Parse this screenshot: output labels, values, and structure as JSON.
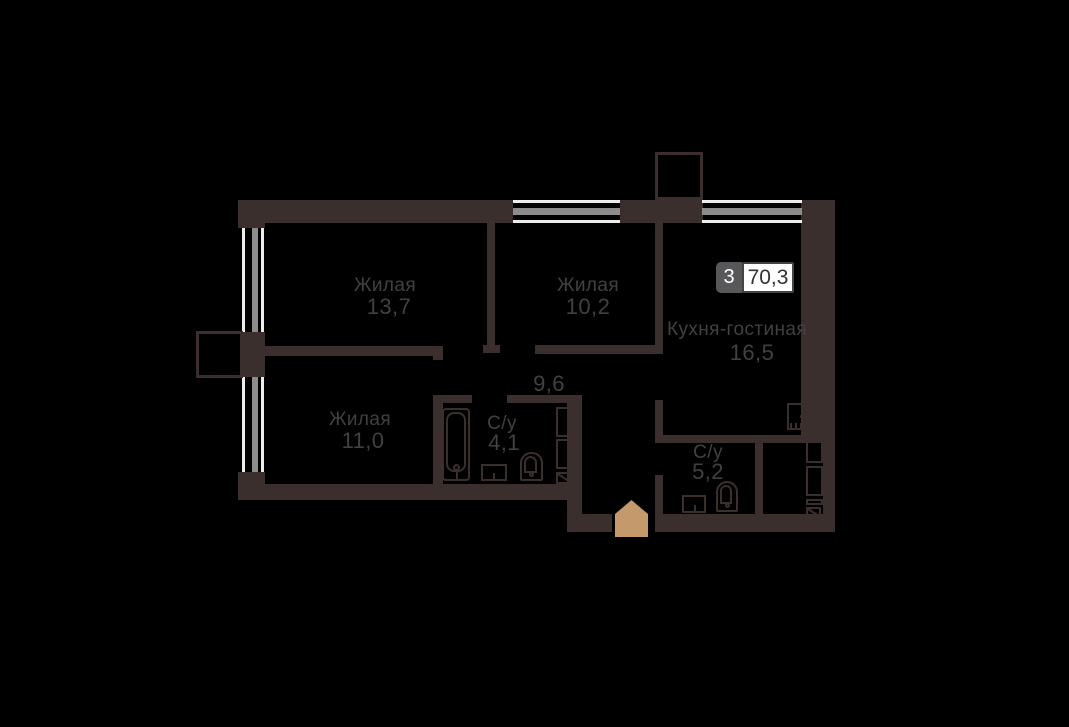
{
  "plan": {
    "badge": {
      "rooms": "3",
      "total_area": "70,3"
    },
    "rooms": [
      {
        "id": "living-13",
        "name": "Жилая",
        "area": "13,7"
      },
      {
        "id": "living-10",
        "name": "Жилая",
        "area": "10,2"
      },
      {
        "id": "kitchen-living",
        "name": "Кухня-гостиная",
        "area": "16,5"
      },
      {
        "id": "hallway",
        "name": "",
        "area": "9,6"
      },
      {
        "id": "living-11",
        "name": "Жилая",
        "area": "11,0"
      },
      {
        "id": "bathroom-1",
        "name": "С/у",
        "area": "4,1"
      },
      {
        "id": "bathroom-2",
        "name": "С/у",
        "area": "5,2"
      }
    ],
    "colors": {
      "background": "#000000",
      "wall": "#3a2f2d",
      "window_frame": "#ededed",
      "window_glass": "#8c8c8c",
      "label": "#414141",
      "entrance": "#c49a6c",
      "badge_gray": "#58585a",
      "badge_white": "#ffffff",
      "badge_border": "#454545",
      "badge_text_dark": "#333333"
    }
  }
}
